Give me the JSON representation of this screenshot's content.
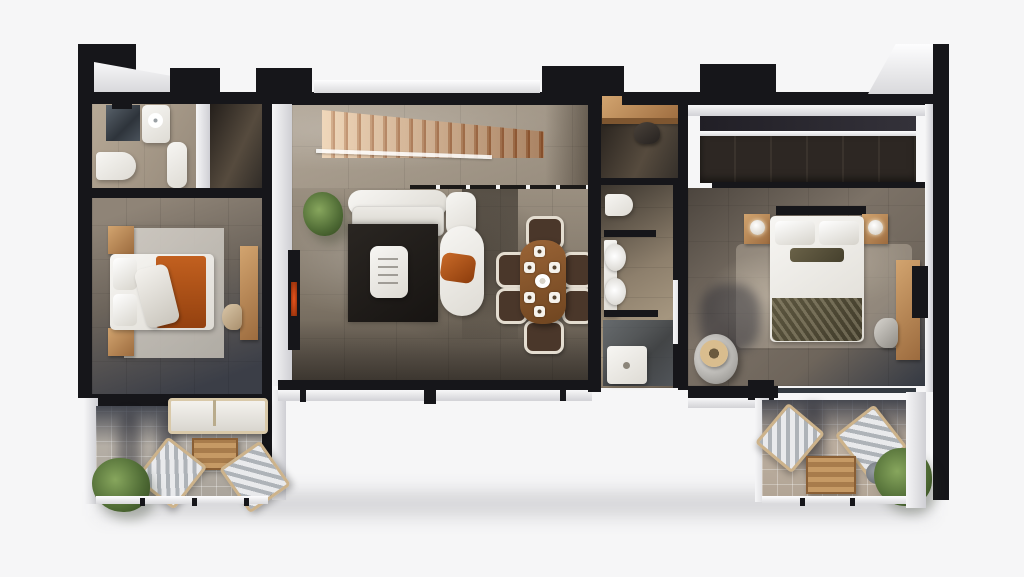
{
  "meta": {
    "description": "3D rendered top-down architectural floor plan of an apartment, isometric dollhouse view, no visible text labels",
    "visible_text": ""
  },
  "palette": {
    "bg": "#f6f6f7",
    "wall": "#16161a",
    "faceLight": "#f5f5f6",
    "faceShade": "#cfcfd3",
    "stoneFloor": "#a89d8e",
    "livingFloor": "#968b7c",
    "bathFloor": "#b4a794",
    "corridorFloor": "#46403a",
    "bedroomFloorLeft": "#6e675f",
    "bedroomFloorRight": "#7d7468",
    "balconyTile": "#b9b3ab",
    "rugLight": "#ccc8c1",
    "rugDark": "#211d1a",
    "wood": "#c1905c",
    "stairLight": "#e6c39c",
    "stairDark": "#a9623a",
    "whiteFurniture": "#f1f0ed",
    "accentOrange": "#b65720",
    "oliveBedding": "#55503a",
    "plantGreen": "#5f7d43",
    "tvGlow": "#d84e1e",
    "showerGlass": "#454e57",
    "shadowNavy": "#232937"
  },
  "rooms": [
    {
      "id": "bathroom-left",
      "label": "Bathroom (left wing)"
    },
    {
      "id": "hall-left",
      "label": "Closet hall (left wing)"
    },
    {
      "id": "bedroom-left",
      "label": "Bedroom (left wing)"
    },
    {
      "id": "balcony-left",
      "label": "Balcony (left wing)"
    },
    {
      "id": "stair-hall",
      "label": "Staircase hall"
    },
    {
      "id": "living-room",
      "label": "Living room"
    },
    {
      "id": "dining-area",
      "label": "Dining area"
    },
    {
      "id": "corridor-desk",
      "label": "Desk nook corridor"
    },
    {
      "id": "bathroom-main",
      "label": "Main bathroom"
    },
    {
      "id": "bedroom-right",
      "label": "Bedroom (right wing)"
    },
    {
      "id": "balcony-right",
      "label": "Balcony (right wing)"
    }
  ],
  "furniture": [
    "shower",
    "vanity-sink",
    "toilet",
    "bathtub",
    "double-bed-orange-bedding",
    "nightstands",
    "area-rug",
    "writing-desk",
    "desk-chair",
    "outdoor-daybed",
    "outdoor-coffee-table",
    "lounge-chairs",
    "potted-plants",
    "wooden-staircase",
    "glass-railing",
    "sofa",
    "chaise-lounge",
    "dark-rug",
    "white-coffee-table",
    "wall-tv",
    "dining-table",
    "dining-chairs",
    "built-in-desk",
    "toilet-main",
    "double-sinks",
    "walk-in-shower",
    "wardrobe-closet",
    "double-bed-olive-bedding",
    "bedside-lamps",
    "round-armchair-with-hat",
    "desk-with-monitor"
  ]
}
